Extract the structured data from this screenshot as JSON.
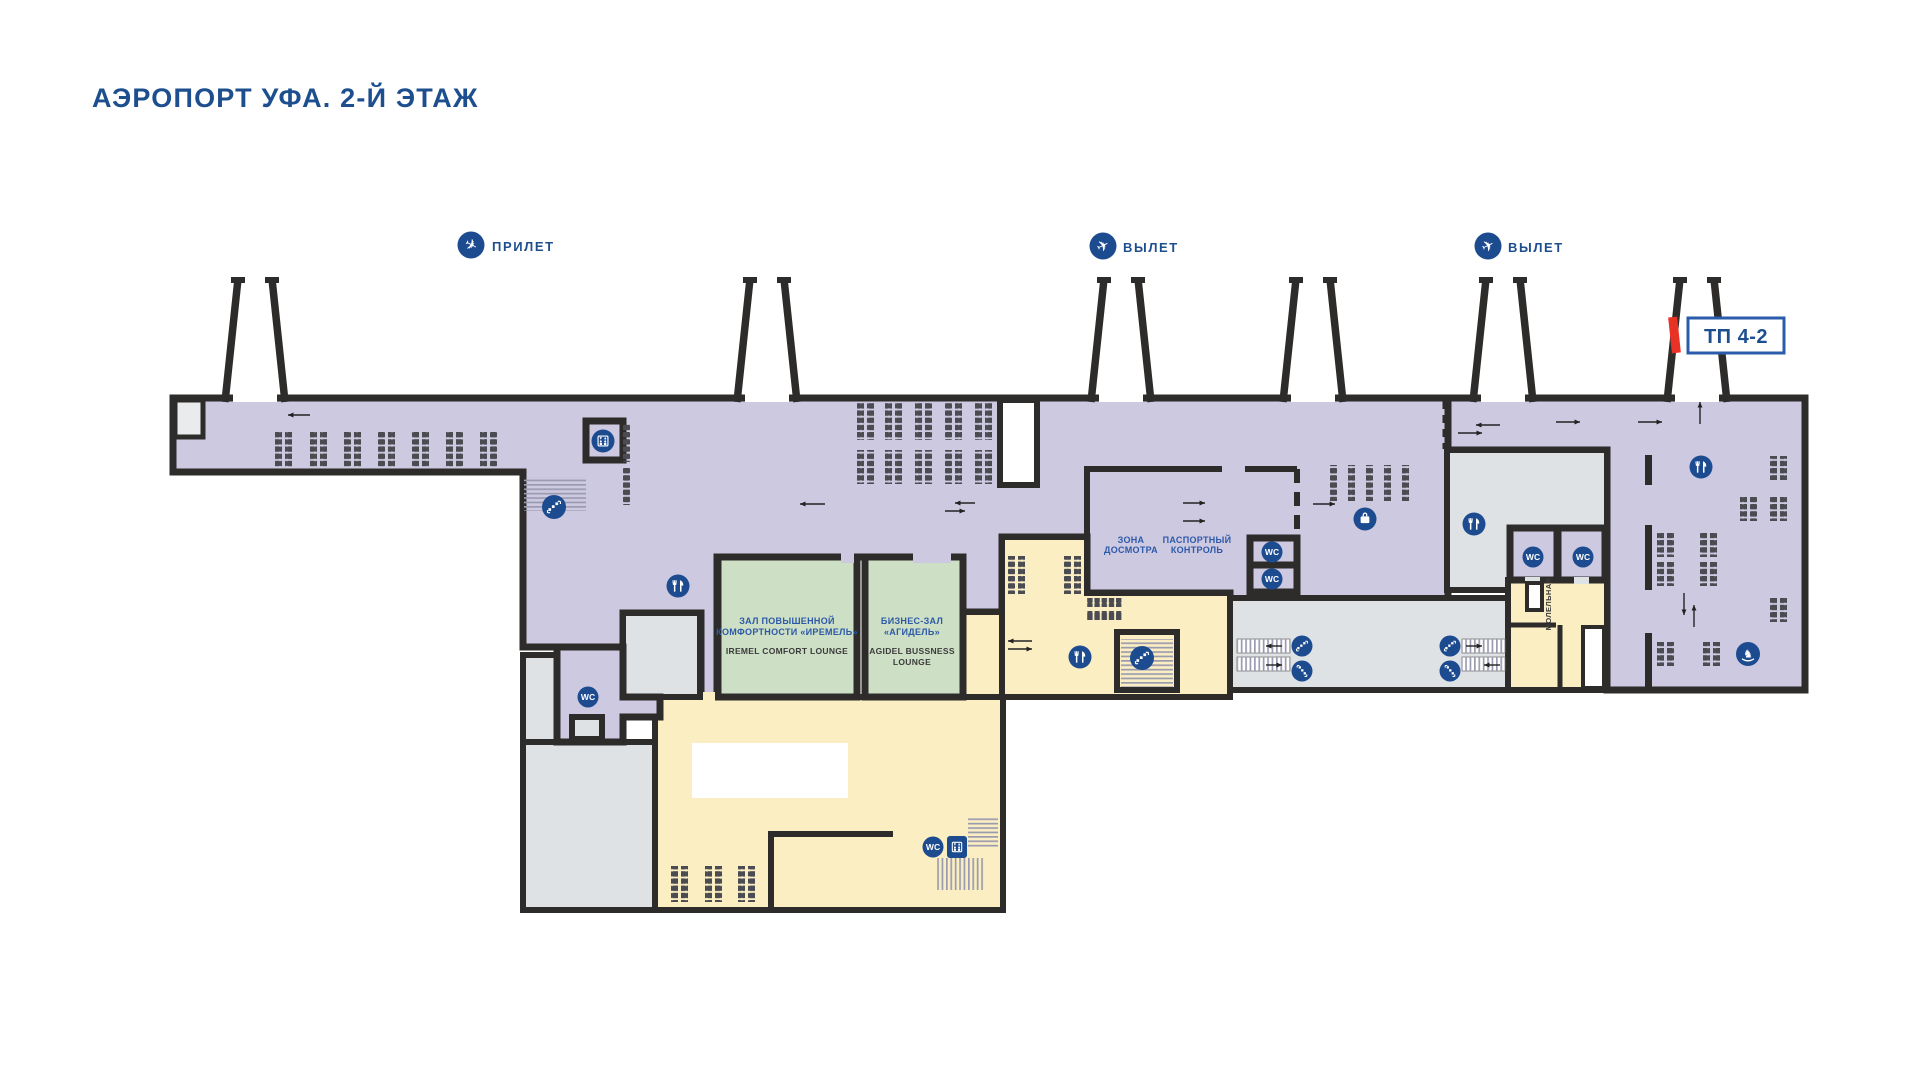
{
  "title": "АЭРОПОРТ УФА. 2-Й ЭТАЖ",
  "legend": {
    "arrivals": "ПРИЛЕТ",
    "departures_left": "ВЫЛЕТ",
    "departures_right": "ВЫЛЕТ"
  },
  "gate_sign": {
    "label": "ТП 4-2"
  },
  "rooms": {
    "lounge_iremel": {
      "title_line1": "ЗАЛ ПОВЫШЕННОЙ",
      "title_line2": "КОМФОРТНОСТИ «ИРЕМЕЛЬ»",
      "subtitle": "IREMEL COMFORT LOUNGE"
    },
    "lounge_agidel": {
      "title_line1": "БИЗНЕС-ЗАЛ",
      "title_line2": "«АГИДЕЛЬ»",
      "subtitle_line1": "AGIDEL BUSSNESS",
      "subtitle_line2": "LOUNGE"
    },
    "security_zone": {
      "line1": "ЗОНА",
      "line2": "ДОСМОТРА"
    },
    "passport_control": {
      "line1": "ПАСПОРТНЫЙ",
      "line2": "КОНТРОЛЬ"
    },
    "prayer_room": {
      "label": "МОЛЕЛЬНАЯ"
    },
    "wc_label": "WC"
  },
  "icons": {
    "arrival": "plane-landing",
    "departure": "plane-takeoff",
    "wc": "wc-sign",
    "restaurant": "fork-and-knife",
    "escalator": "escalator-stairs",
    "elevator": "elevator-cab",
    "luggage": "suitcase",
    "kids_zone": "rocking-horse"
  },
  "colors": {
    "accent_blue": "#1c4b8f",
    "text_blue": "#1d4f8f",
    "zone_purple": "#cdc9e1",
    "zone_gray": "#dfe2e5",
    "zone_green": "#cddfc5",
    "zone_yellow": "#faeec2",
    "wall": "#2d2c2b",
    "red_marker": "#e83226",
    "bench": "#4b4b52"
  }
}
